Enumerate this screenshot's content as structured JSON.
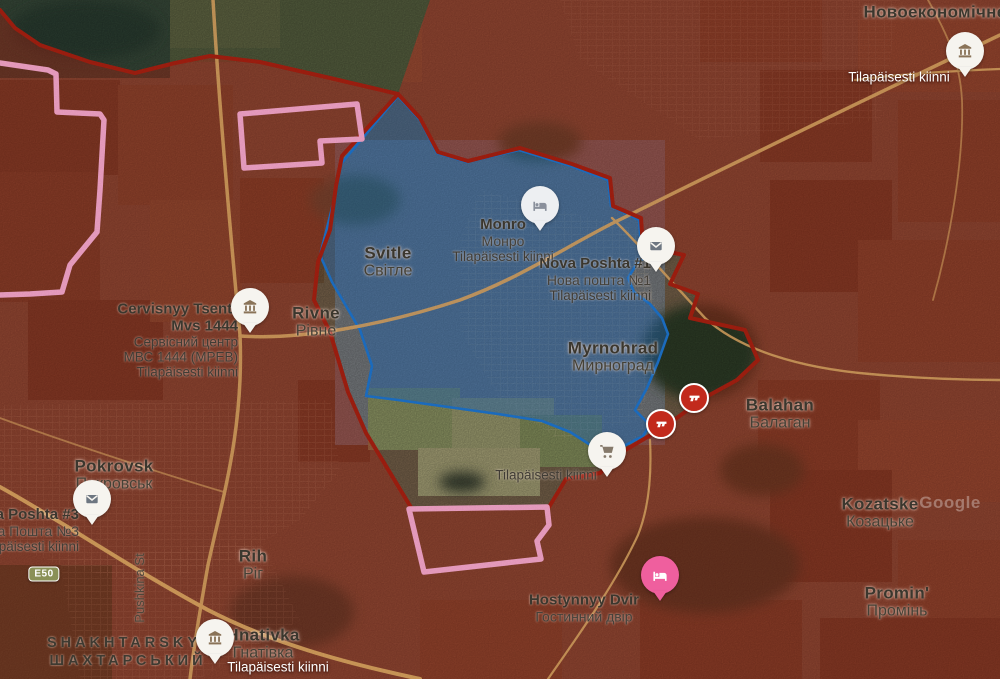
{
  "colors": {
    "occupied_fill": "rgba(175,36,20,0.42)",
    "occupied_border": "#a31f10",
    "contested_fill": "rgba(36,104,178,0.47)",
    "contested_border": "#1d72c9",
    "claim_border_pink": "#f2a3c7",
    "road": "#d4a05e",
    "pin_white": "#f6f4ef",
    "pin_gray": "#edeff2",
    "pin_pink": "#ef5f9e",
    "gun_marker_red": "#c22a1c"
  },
  "road_badge": {
    "label": "E50",
    "x": 44,
    "y": 574
  },
  "watermark": {
    "text": "Google",
    "x": 950,
    "y": 503
  },
  "labels": [
    {
      "name": "novoekonomichne",
      "x": 935,
      "y": 12,
      "lines": [
        {
          "text": "Новоекономічне",
          "style": "l-city"
        }
      ]
    },
    {
      "name": "tilap-northeast",
      "x": 899,
      "y": 77,
      "lines": [
        {
          "text": "Tilapäisesti kiinni",
          "style": "l-wt"
        }
      ]
    },
    {
      "name": "svitle",
      "x": 388,
      "y": 262,
      "lines": [
        {
          "text": "Svitle",
          "style": "l-city"
        },
        {
          "text": "Світле",
          "style": "l-city2"
        }
      ]
    },
    {
      "name": "monro",
      "x": 503,
      "y": 240,
      "lines": [
        {
          "text": "Monro",
          "style": "l-poi"
        },
        {
          "text": "Монро",
          "style": "l-poi2"
        },
        {
          "text": "Tilapäisesti kiinni",
          "style": "l-sm"
        }
      ]
    },
    {
      "name": "nova-poshta-1",
      "x": 651,
      "y": 279,
      "align": "right",
      "lines": [
        {
          "text": "Nova Poshta #1",
          "style": "l-poi"
        },
        {
          "text": "Нова пошта №1",
          "style": "l-poi2"
        },
        {
          "text": "Tilapäisesti kiinni",
          "style": "l-sm"
        }
      ]
    },
    {
      "name": "cervisnyy-tsentr",
      "x": 238,
      "y": 340,
      "align": "right",
      "lines": [
        {
          "text": "Cervisnyy Tsentr",
          "style": "l-poi"
        },
        {
          "text": "Mvs 1444",
          "style": "l-poi"
        },
        {
          "text": "Сервісний центр",
          "style": "l-sm"
        },
        {
          "text": "МВС 1444 (МРЕВ)",
          "style": "l-sm"
        },
        {
          "text": "Tilapäisesti kiinni",
          "style": "l-sm"
        }
      ]
    },
    {
      "name": "rivne",
      "x": 316,
      "y": 322,
      "lines": [
        {
          "text": "Rivne",
          "style": "l-city"
        },
        {
          "text": "Рівне",
          "style": "l-city2"
        }
      ]
    },
    {
      "name": "myrnohrad",
      "x": 613,
      "y": 357,
      "lines": [
        {
          "text": "Myrnohrad",
          "style": "l-city"
        },
        {
          "text": "Мирноград",
          "style": "l-city2"
        }
      ]
    },
    {
      "name": "balahan",
      "x": 780,
      "y": 414,
      "lines": [
        {
          "text": "Balahan",
          "style": "l-city"
        },
        {
          "text": "Балаган",
          "style": "l-city2"
        }
      ]
    },
    {
      "name": "pokrovsk",
      "x": 114,
      "y": 475,
      "lines": [
        {
          "text": "Pokrovsk",
          "style": "l-city"
        },
        {
          "text": "Покровськ",
          "style": "l-city2"
        }
      ]
    },
    {
      "name": "nova-poshta-3",
      "x": 79,
      "y": 530,
      "align": "right",
      "lines": [
        {
          "text": "Nova Poshta #3",
          "style": "l-poi"
        },
        {
          "text": "Нова Пошта №3",
          "style": "l-poi2"
        },
        {
          "text": "Tilapäisesti kiinni",
          "style": "l-sm"
        }
      ]
    },
    {
      "name": "tilap-cart",
      "x": 546,
      "y": 475,
      "lines": [
        {
          "text": "Tilapäisesti kiinni",
          "style": "l-sm"
        }
      ]
    },
    {
      "name": "kozatske",
      "x": 880,
      "y": 513,
      "lines": [
        {
          "text": "Kozatske",
          "style": "l-city"
        },
        {
          "text": "Козацьке",
          "style": "l-city2"
        }
      ]
    },
    {
      "name": "rih",
      "x": 253,
      "y": 565,
      "lines": [
        {
          "text": "Rih",
          "style": "l-city"
        },
        {
          "text": "Ріг",
          "style": "l-city2"
        }
      ]
    },
    {
      "name": "promin",
      "x": 897,
      "y": 602,
      "lines": [
        {
          "text": "Promin'",
          "style": "l-city"
        },
        {
          "text": "Промінь",
          "style": "l-city2"
        }
      ]
    },
    {
      "name": "hostynnyy-dvir",
      "x": 584,
      "y": 608,
      "lines": [
        {
          "text": "Hostynnyy Dvir",
          "style": "l-poi"
        },
        {
          "text": "Гостинний двір",
          "style": "l-poi2"
        }
      ]
    },
    {
      "name": "shakhtarskyi",
      "x": 128,
      "y": 652,
      "lines": [
        {
          "text": "SHAKHTARSKYI",
          "style": "l-dist"
        },
        {
          "text": "ШАХТАРСЬКИЙ",
          "style": "l-dist"
        }
      ]
    },
    {
      "name": "hnativka",
      "x": 263,
      "y": 644,
      "lines": [
        {
          "text": "Hnativka",
          "style": "l-city"
        },
        {
          "text": "Гнатівка",
          "style": "l-city2"
        }
      ]
    },
    {
      "name": "tilap-hnativka",
      "x": 278,
      "y": 667,
      "lines": [
        {
          "text": "Tilapäisesti kiinni",
          "style": "l-wt"
        }
      ]
    },
    {
      "name": "pushkina-street",
      "x": 140,
      "y": 588,
      "rotate": true,
      "lines": [
        {
          "text": "Pushkina St",
          "style": "l-street"
        }
      ]
    }
  ],
  "icons": [
    {
      "name": "museum-pin-icon",
      "type": "bank",
      "x": 965,
      "y": 77,
      "fill": "#f6f4ef",
      "glyph": "#8a7358"
    },
    {
      "name": "hotel-pin-monro-icon",
      "type": "bed",
      "x": 540,
      "y": 231,
      "fill": "#edeff2",
      "glyph": "#8a909c"
    },
    {
      "name": "mail-pin-novaposhta1-icon",
      "type": "mail",
      "x": 656,
      "y": 272,
      "fill": "#f6f4ef",
      "glyph": "#6d7681"
    },
    {
      "name": "bank-pin-cervisnyy-icon",
      "type": "bank",
      "x": 250,
      "y": 333,
      "fill": "#f6f4ef",
      "glyph": "#8a7358"
    },
    {
      "name": "gun-marker-north-icon",
      "type": "gun",
      "x": 694,
      "y": 398,
      "fill": "#c22a1c",
      "glyph": "#ffffff"
    },
    {
      "name": "gun-marker-south-icon",
      "type": "gun",
      "x": 661,
      "y": 424,
      "fill": "#c22a1c",
      "glyph": "#ffffff"
    },
    {
      "name": "cart-pin-icon",
      "type": "cart",
      "x": 607,
      "y": 477,
      "fill": "#f6f4ef",
      "glyph": "#85796a"
    },
    {
      "name": "mail-pin-novaposhta3-icon",
      "type": "mail",
      "x": 92,
      "y": 525,
      "fill": "#f6f4ef",
      "glyph": "#6d7681"
    },
    {
      "name": "hotel-pin-hostynnyy-icon",
      "type": "bed",
      "x": 660,
      "y": 601,
      "fill": "#ef5f9e",
      "glyph": "#ffffff"
    },
    {
      "name": "bank-pin-hnativka-icon",
      "type": "bank",
      "x": 215,
      "y": 664,
      "fill": "#f6f4ef",
      "glyph": "#8a7358"
    }
  ]
}
